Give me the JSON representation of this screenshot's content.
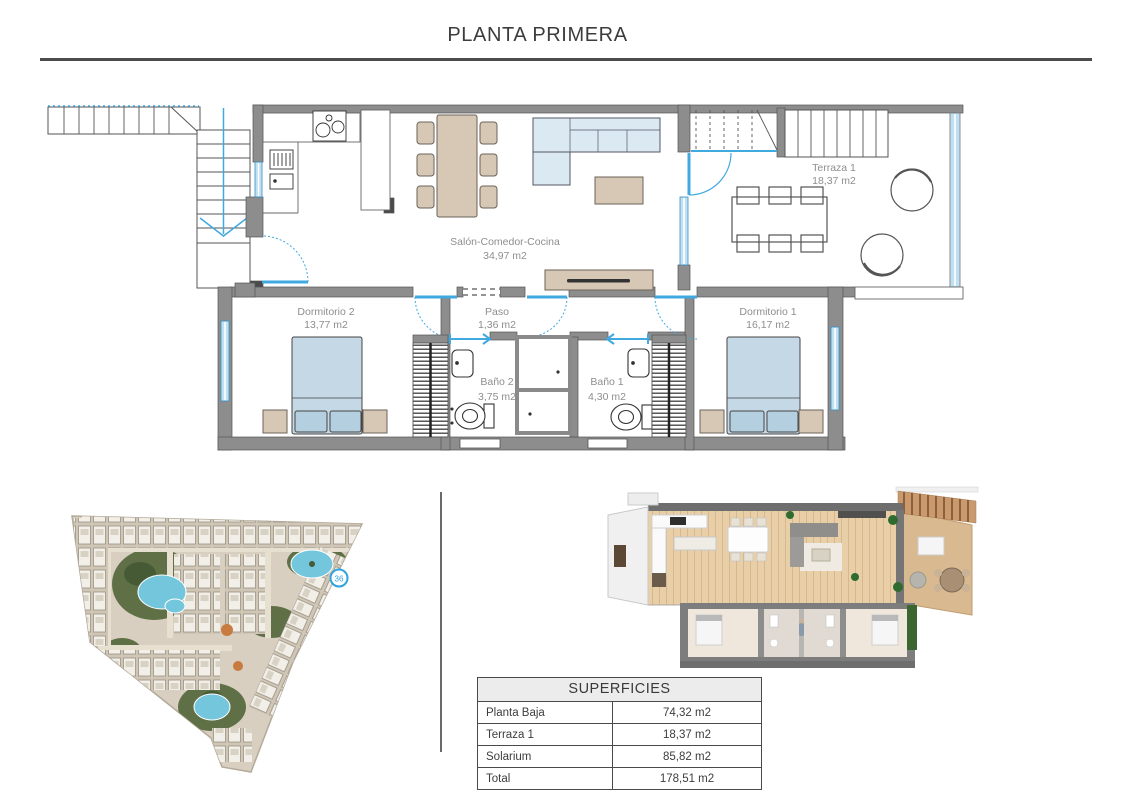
{
  "page": {
    "title": "PLANTA PRIMERA"
  },
  "floorplan": {
    "rooms": [
      {
        "name": "Salón-Comedor-Cocina",
        "area": "34,97 m2"
      },
      {
        "name": "Terraza 1",
        "area": "18,37 m2"
      },
      {
        "name": "Dormitorio 2",
        "area": "13,77 m2"
      },
      {
        "name": "Paso",
        "area": "1,36 m2"
      },
      {
        "name": "Dormitorio 1",
        "area": "16,17 m2"
      },
      {
        "name": "Baño 2",
        "area": "3,75 m2"
      },
      {
        "name": "Baño 1",
        "area": "4,30 m2"
      }
    ]
  },
  "site_plan": {
    "unit_marker": "36"
  },
  "surfaces_table": {
    "title": "SUPERFICIES",
    "rows": [
      {
        "label": "Planta Baja",
        "value": "74,32 m2"
      },
      {
        "label": "Terraza 1",
        "value": "18,37 m2"
      },
      {
        "label": "Solarium",
        "value": "85,82 m2"
      },
      {
        "label": "Total",
        "value": "178,51 m2"
      }
    ]
  },
  "colors": {
    "wall_gray": "#8d8d8d",
    "door_blue": "#3fa9e0",
    "window_blue": "#bfe0f2",
    "furniture_tan": "#d7c8b6",
    "bed_blue": "#c4d8e5",
    "label_gray": "#8e8e8e"
  }
}
